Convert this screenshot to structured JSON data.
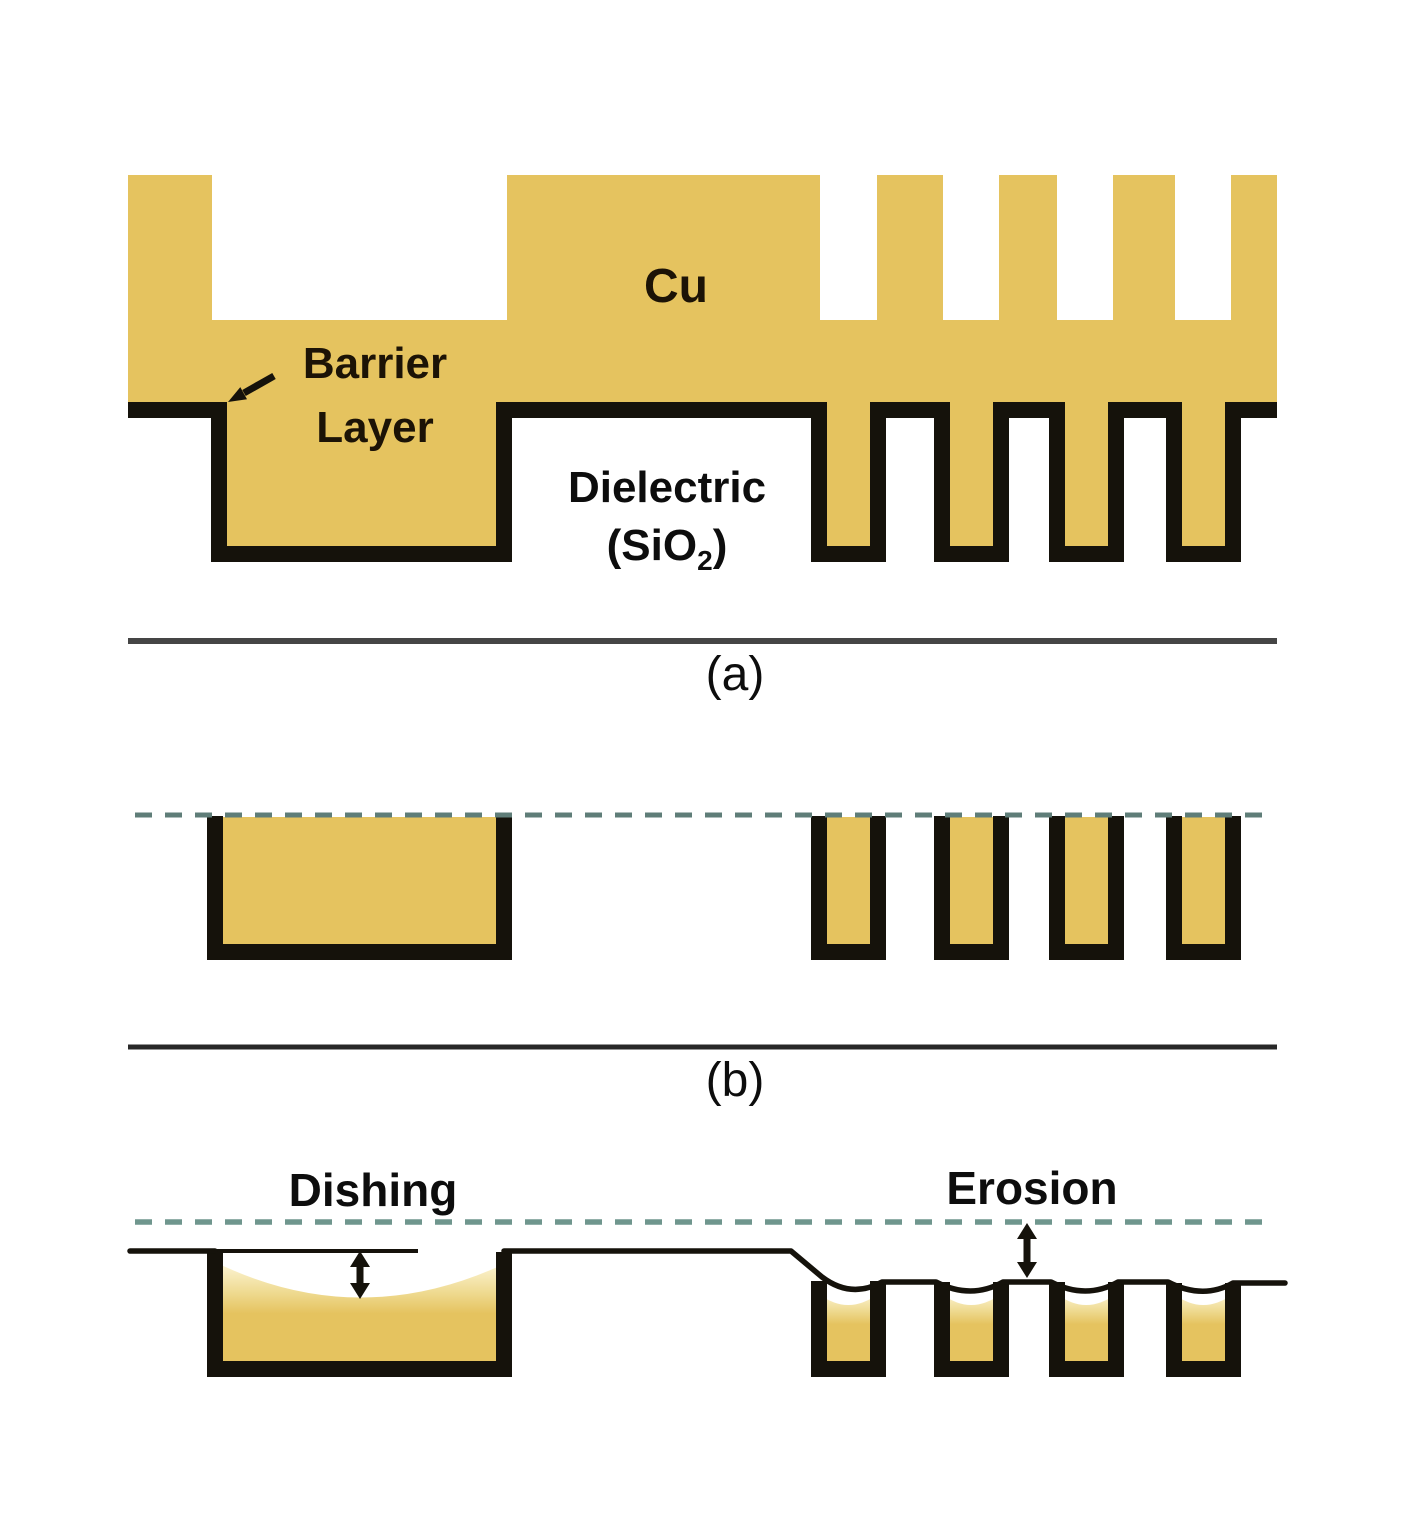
{
  "panel_a": {
    "label": "(a)",
    "cu_label": "Cu",
    "barrier_label_line1": "Barrier",
    "barrier_label_line2": "Layer",
    "dielectric_label_line1": "Dielectric",
    "dielectric_label_line2_pre": "(SiO",
    "dielectric_label_subscript": "2",
    "dielectric_label_line2_post": ")"
  },
  "panel_b": {
    "label": "(b)"
  },
  "panel_c": {
    "dishing_label": "Dishing",
    "erosion_label": "Erosion"
  },
  "colors": {
    "copper": "#e5c35f",
    "barrier": "#15120b",
    "guide_b": "#5f7d78",
    "guide_c": "#6f968d",
    "separator_a": "#454545",
    "separator_b": "#282828",
    "label_on_copper": "#1c1306",
    "label_black": "#0d0d0d"
  }
}
